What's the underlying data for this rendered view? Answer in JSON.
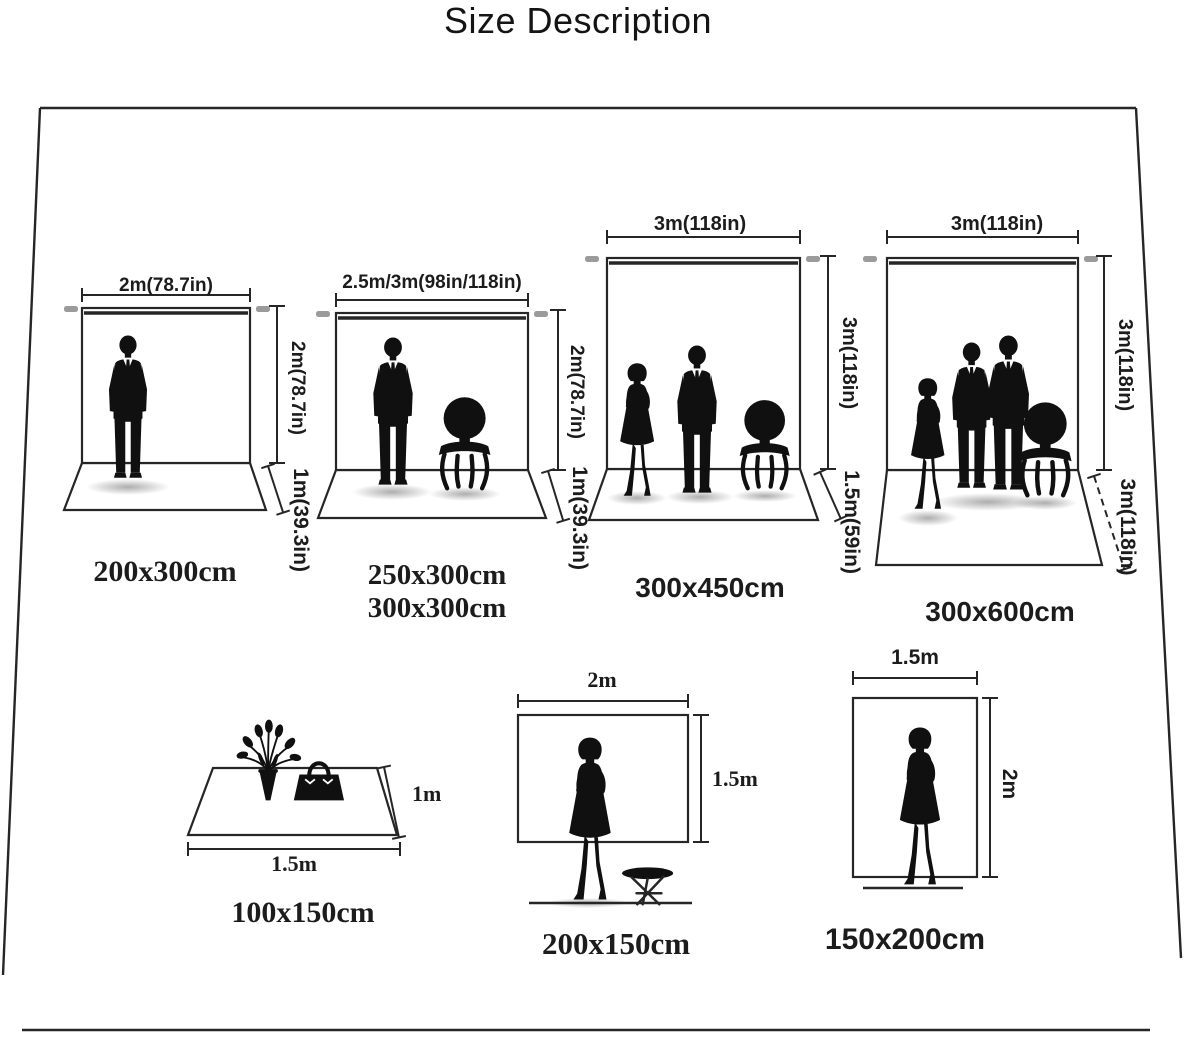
{
  "title": "Size Description",
  "backdrops": [
    {
      "width_label": "2m(78.7in)",
      "height_label": "2m(78.7in)",
      "floor_label": "1m(39.3in)",
      "caption": "200x300cm",
      "figures": "man-silhouette"
    },
    {
      "width_label": "2.5m/3m(98in/118in)",
      "height_label": "2m(78.7in)",
      "floor_label": "1m(39.3in)",
      "caption": "250x300cm",
      "caption2": "300x300cm",
      "figures": "man-and-chair-silhouette"
    },
    {
      "width_label": "3m(118in)",
      "height_label": "3m(118in)",
      "floor_label": "1.5m(59in)",
      "caption": "300x450cm",
      "figures": "woman-man-chair-silhouette"
    },
    {
      "width_label": "3m(118in)",
      "height_label": "3m(118in)",
      "floor_label": "3m(118in)",
      "caption": "300x600cm",
      "figures": "woman-two-men-chair-silhouette"
    }
  ],
  "flat": [
    {
      "width_label": "1.5m",
      "height_label": "1m",
      "caption": "100x150cm",
      "contents": "flower-vase-and-handbag"
    },
    {
      "width_label": "2m",
      "height_label": "1.5m",
      "caption": "200x150cm",
      "contents": "woman-and-stool"
    },
    {
      "width_label": "1.5m",
      "height_label": "2m",
      "caption": "150x200cm",
      "contents": "woman"
    }
  ],
  "colors": {
    "ink": "#262626",
    "pole_gray": "#9b9b9b"
  }
}
